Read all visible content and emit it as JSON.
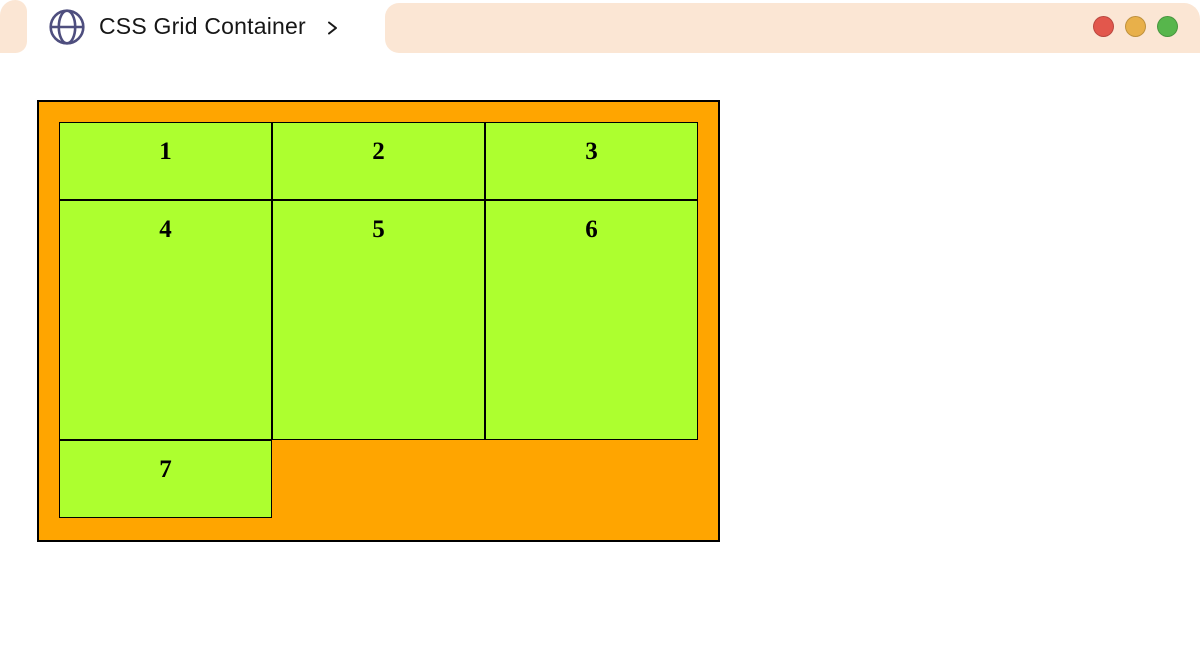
{
  "header": {
    "bar_color": "#FBE6D4",
    "tab": {
      "title": "CSS Grid Container",
      "favicon": "globe-icon",
      "expander": "chevron-right-icon"
    },
    "traffic_lights": [
      {
        "name": "close",
        "color": "#E2574C"
      },
      {
        "name": "minimize",
        "color": "#E8B04A"
      },
      {
        "name": "maximize",
        "color": "#57B64C"
      }
    ]
  },
  "grid": {
    "container_color": "#FFA500",
    "cell_color": "#ADFF2F",
    "border_color": "#000000",
    "cells": [
      "1",
      "2",
      "3",
      "4",
      "5",
      "6",
      "7"
    ]
  }
}
